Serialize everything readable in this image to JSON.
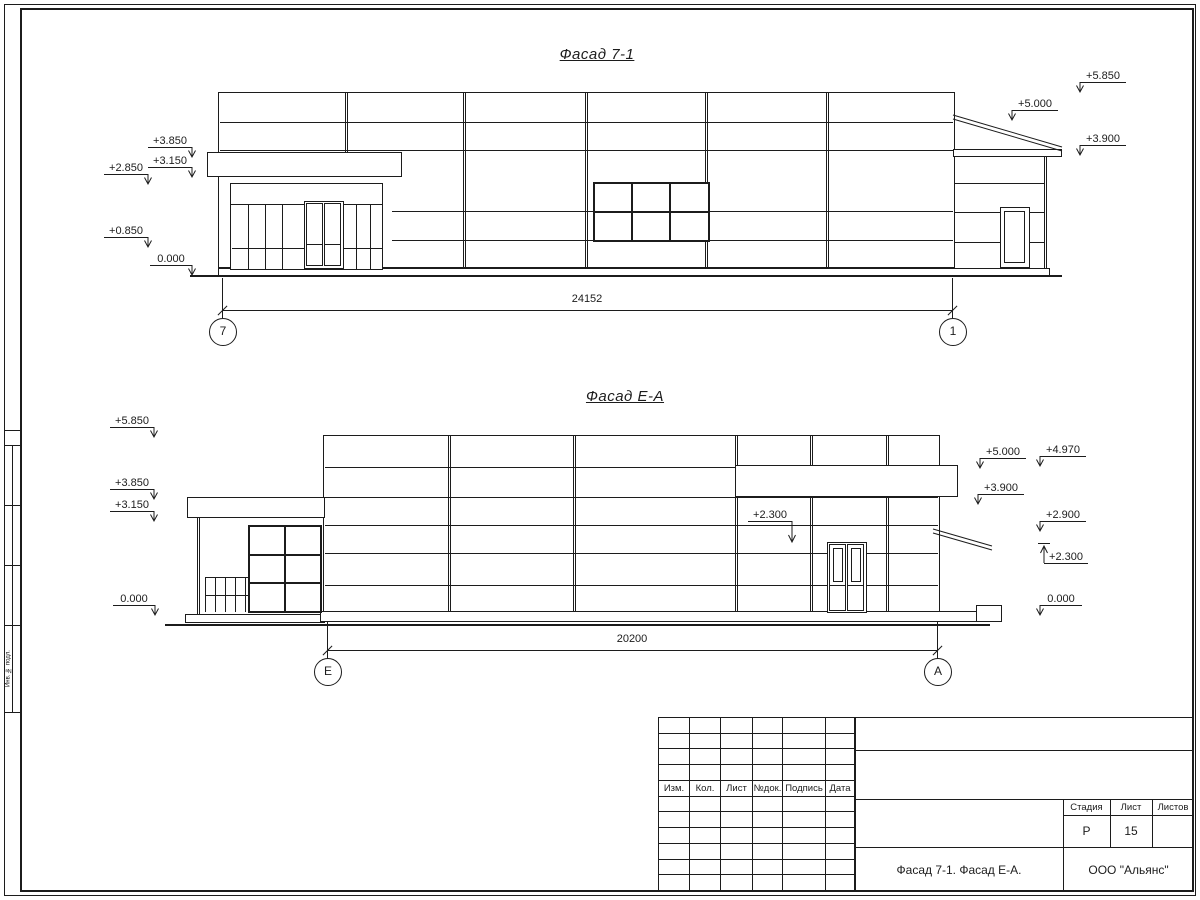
{
  "facade1": {
    "title": "Фасад 7-1",
    "dimension": "24152",
    "axis_left": "7",
    "axis_right": "1",
    "marks": [
      {
        "label": "+3.850",
        "x": 148,
        "y": 147,
        "w": 44,
        "arrow": "right"
      },
      {
        "label": "+3.150",
        "x": 148,
        "y": 167,
        "w": 44,
        "arrow": "right"
      },
      {
        "label": "+2.850",
        "x": 104,
        "y": 174,
        "w": 44,
        "arrow": "right"
      },
      {
        "label": "+0.850",
        "x": 104,
        "y": 237,
        "w": 44,
        "arrow": "right"
      },
      {
        "label": "0.000",
        "x": 150,
        "y": 265,
        "w": 42,
        "arrow": "right"
      },
      {
        "label": "+5.850",
        "x": 1080,
        "y": 82,
        "w": 46,
        "arrow": "left"
      },
      {
        "label": "+5.000",
        "x": 1012,
        "y": 110,
        "w": 46,
        "arrow": "left"
      },
      {
        "label": "+3.900",
        "x": 1080,
        "y": 145,
        "w": 46,
        "arrow": "left"
      }
    ]
  },
  "facade2": {
    "title": "Фасад Е-А",
    "dimension": "20200",
    "axis_left": "Е",
    "axis_right": "А",
    "marks": [
      {
        "label": "+5.850",
        "x": 110,
        "y": 427,
        "w": 44,
        "arrow": "right"
      },
      {
        "label": "+3.850",
        "x": 110,
        "y": 489,
        "w": 44,
        "arrow": "right"
      },
      {
        "label": "+3.150",
        "x": 110,
        "y": 511,
        "w": 44,
        "arrow": "right"
      },
      {
        "label": "0.000",
        "x": 113,
        "y": 605,
        "w": 42,
        "arrow": "right"
      },
      {
        "label": "+5.000",
        "x": 980,
        "y": 458,
        "w": 46,
        "arrow": "left"
      },
      {
        "label": "+3.900",
        "x": 978,
        "y": 494,
        "w": 46,
        "arrow": "left"
      },
      {
        "label": "+4.970",
        "x": 1040,
        "y": 456,
        "w": 46,
        "arrow": "left"
      },
      {
        "label": "+2.900",
        "x": 1040,
        "y": 521,
        "w": 46,
        "arrow": "left"
      },
      {
        "label": "+2.300",
        "x": 1044,
        "y": 563,
        "w": 44,
        "arrow": "up"
      },
      {
        "label": "0.000",
        "x": 1040,
        "y": 605,
        "w": 42,
        "arrow": "left"
      },
      {
        "label": "+2.300",
        "x": 748,
        "y": 521,
        "w": 44,
        "arrow": "leader-down"
      }
    ]
  },
  "title_block": {
    "columns": [
      "Изм.",
      "Кол.",
      "Лист",
      "№док.",
      "Подпись",
      "Дата"
    ],
    "stage_label": "Стадия",
    "sheet_label": "Лист",
    "sheets_label": "Листов",
    "stage_value": "Р",
    "sheet_value": "15",
    "sheets_value": "",
    "drawing_title": "Фасад 7-1. Фасад Е-А.",
    "company": "ООО \"Альянс\""
  },
  "side_strip": {
    "label": "Инв. № подл."
  }
}
